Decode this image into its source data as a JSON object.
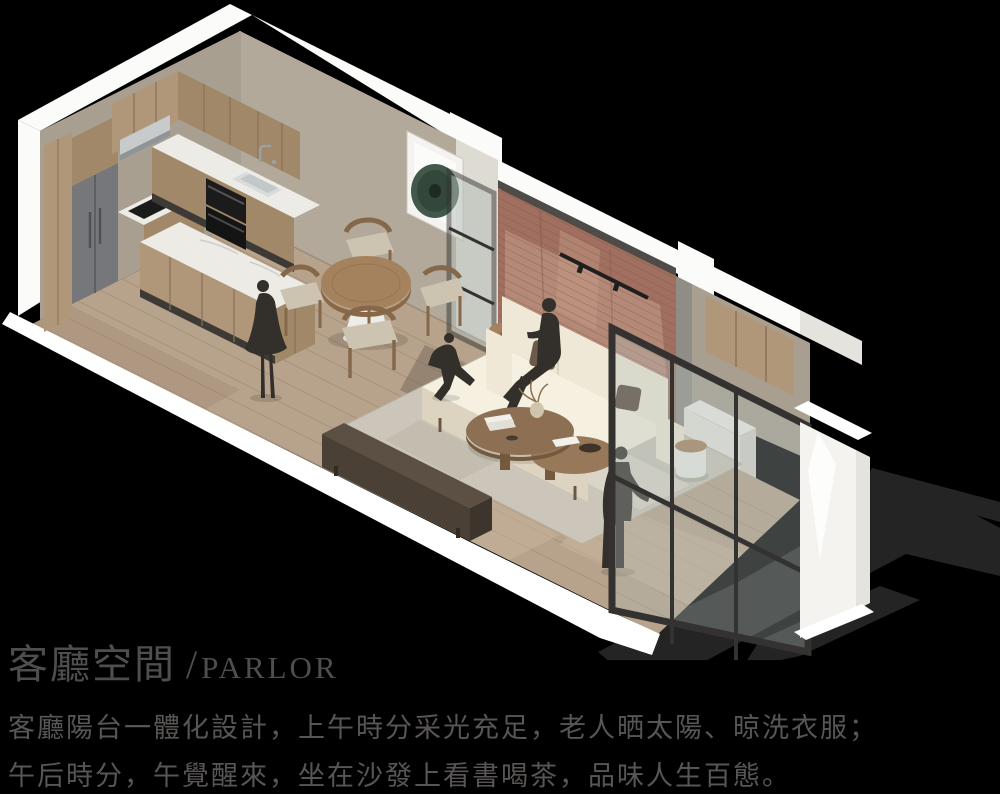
{
  "caption": {
    "title_zh": "客廳空間",
    "title_slash": "/",
    "title_en": "PARLOR",
    "line1": "客廳陽台一體化設計，上午時分采光充足，老人晒太陽、晾洗衣服；",
    "line2": "午后時分，午覺醒來，坐在沙發上看書喝茶，品味人生百態。"
  },
  "scene": {
    "type": "isometric-interior-rendering",
    "description": "Axonometric cutaway rendering of a parlor: open kitchen with island at left, round dining table with four chairs, framed bronze-disc artwork, black steel pivot glass door, red brick mural feature wall behind a cream three-seat sofa, wood coffee tables on a pale rug, low TV console, and an integrated balcony with glazed black-frame windows at right; dark human silhouettes (standing woman, running child, seated reader, standing man)",
    "palette": {
      "bg": "#000000",
      "title": "#504e4d",
      "text": "#585654",
      "shadow": "#242424",
      "wallWhite": "#fbfbf9",
      "wallWhiteShade": "#e4e3de",
      "wallGreige": "#b2a99b",
      "wallGreige2": "#a89f91",
      "pier": "#dedbd3",
      "brick": "#a06f5f",
      "brickLight": "#c79f8a",
      "brickDark": "#7e5546",
      "brickTrim": "#4f4c48",
      "floor": "#b7a28c",
      "floorDark": "#9d8870",
      "floorLine": "#a18a72",
      "floorLight": "#cdb89f",
      "woodCab": "#b0977a",
      "woodCab2": "#a18868",
      "woodSeam": "#8a7257",
      "marble": "#edebe6",
      "fridge": "#75777a",
      "fridgeDark": "#5d5f62",
      "appliance": "#1b1b1b",
      "steel": "#c7cbcc",
      "tableWood": "#a5825e",
      "tableWoodDark": "#8a6847",
      "chairWood": "#85674a",
      "cushion": "#ccc3b1",
      "sofa": "#efe8d7",
      "sofaShade": "#dcd4c0",
      "pillow": "#6e5a48",
      "pillow2": "#57483c",
      "rug": "#cbc6b9",
      "rugShade": "#b7b2a3",
      "rugLight": "#dfdbce",
      "coffeeWood": "#8d7053",
      "console": "#4b4036",
      "consoleTop": "#5c5044",
      "figure": "#332f2b",
      "frame": "#333230",
      "glass": "#b2bcb6",
      "artGreen": "#41584a",
      "artGreenDark": "#2a3c31",
      "white": "#ffffff"
    },
    "objects": [
      "kitchen-cabinets",
      "refrigerator",
      "range-hood",
      "cooktop",
      "wall-ovens",
      "sink",
      "kitchen-island",
      "dining-table",
      "dining-chairs",
      "wall-art-bronze-disc",
      "glass-pivot-door",
      "brick-mural-wall",
      "track-light",
      "sofa",
      "pillows",
      "coffee-tables",
      "vase",
      "books",
      "rug",
      "side-tables",
      "tv-console",
      "balcony-cabinets",
      "laundry-counter",
      "window-wall",
      "figure-woman",
      "figure-child",
      "figure-seated",
      "figure-man"
    ]
  }
}
